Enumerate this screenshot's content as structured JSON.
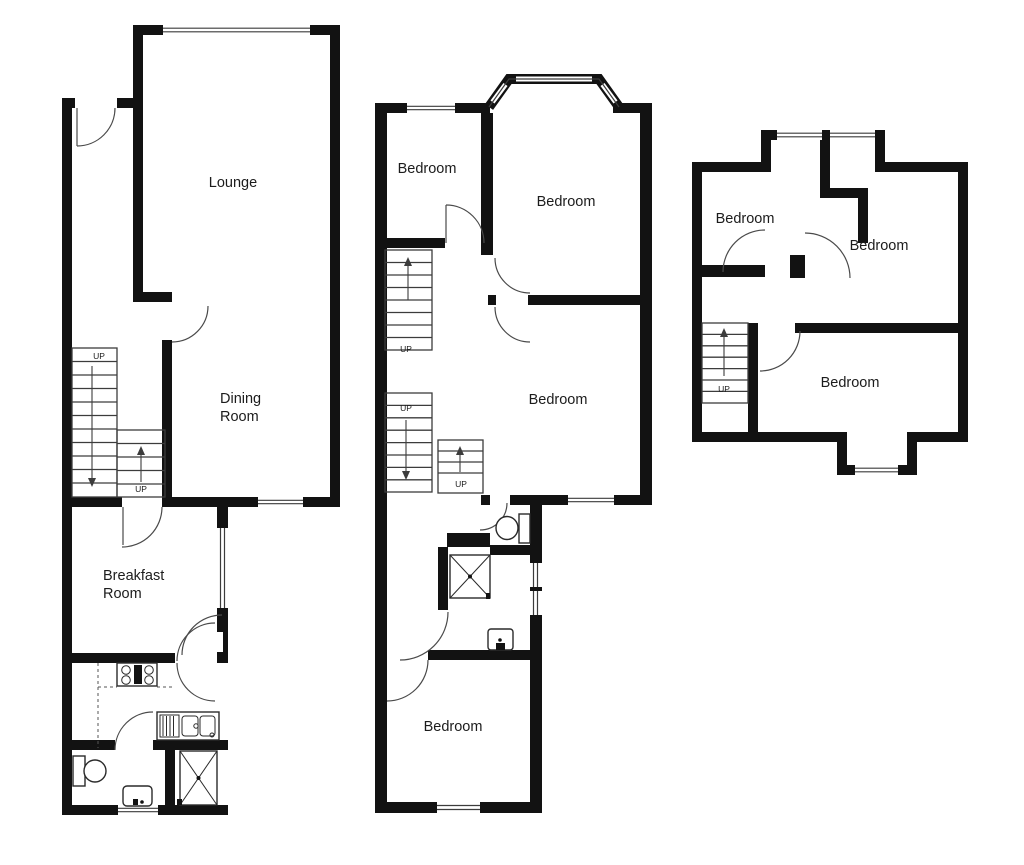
{
  "colors": {
    "wall": "#121212",
    "line": "#3c3c3c",
    "bg": "#ffffff",
    "text": "#1c1c1c"
  },
  "plans": {
    "ground": {
      "rooms": {
        "lounge": "Lounge",
        "dining_1": "Dining",
        "dining_2": "Room",
        "breakfast_1": "Breakfast",
        "breakfast_2": "Room"
      },
      "stairs": {
        "up1": "UP",
        "up2": "UP"
      }
    },
    "first": {
      "rooms": {
        "bedroom1": "Bedroom",
        "bedroom2": "Bedroom",
        "bedroom3": "Bedroom",
        "bedroom4": "Bedroom"
      },
      "stairs": {
        "up1": "UP",
        "up2": "UP",
        "up3": "UP"
      }
    },
    "second": {
      "rooms": {
        "bedroom1": "Bedroom",
        "bedroom2": "Bedroom",
        "bedroom3": "Bedroom"
      },
      "stairs": {
        "up1": "UP"
      }
    }
  }
}
